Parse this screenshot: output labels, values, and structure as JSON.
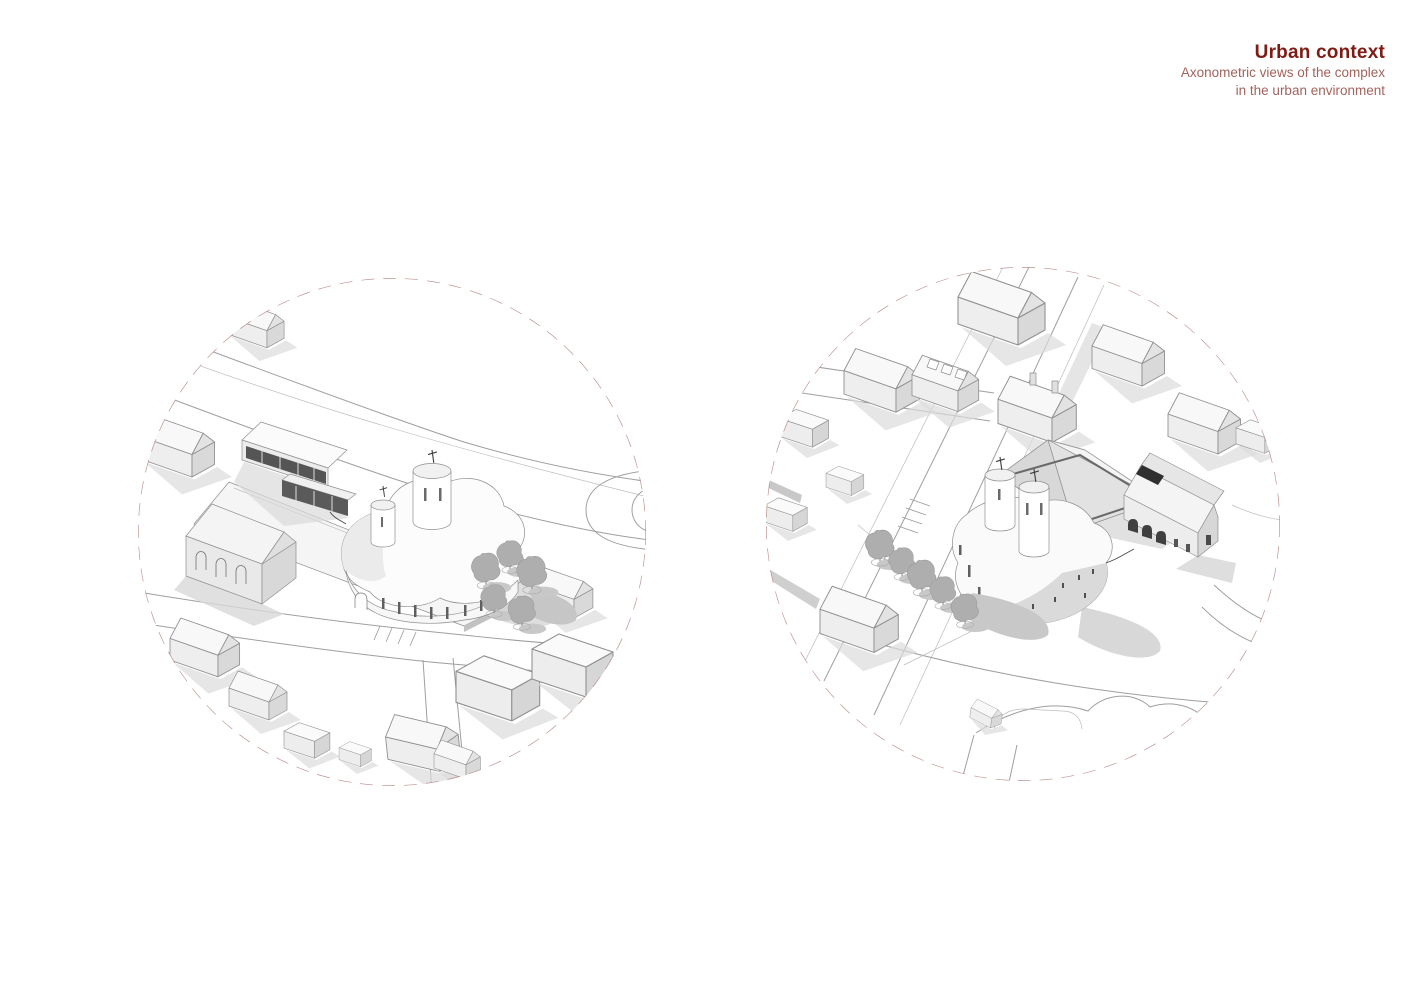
{
  "page": {
    "background": "#ffffff",
    "header": {
      "title": "Urban context",
      "subtitle_line1": "Axonometric views of the complex",
      "subtitle_line2": "in the urban environment"
    },
    "colors": {
      "title": "#7e1b15",
      "subtitle": "#a2635d",
      "circle_dash": "#bb928e",
      "drawing_line": "#8f8f8f"
    }
  }
}
